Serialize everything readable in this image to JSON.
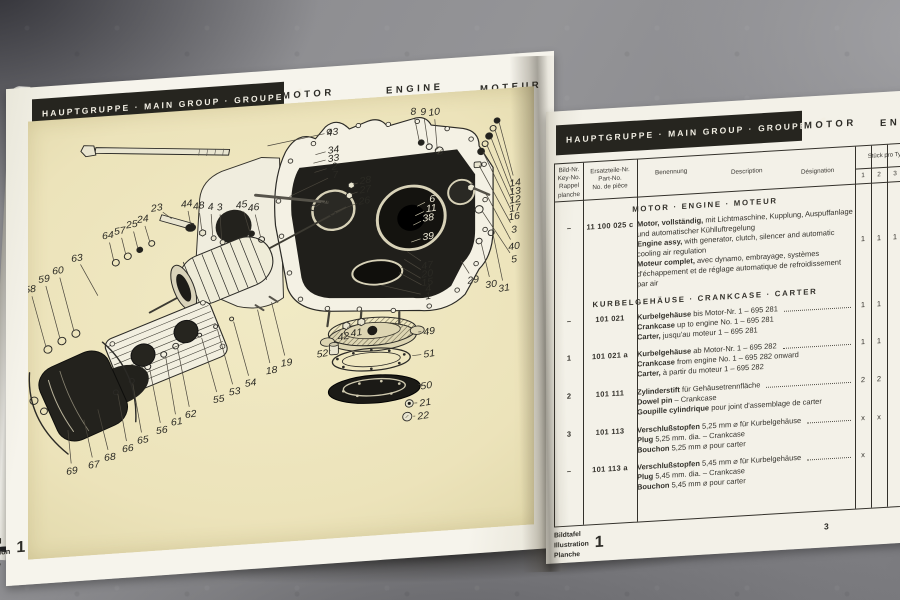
{
  "colors": {
    "plate_background": "#f1eac5",
    "header_bar": "#26251f",
    "page_paper": "#f3f1e8",
    "table_ink": "#33312b"
  },
  "left_page": {
    "header": {
      "group_label": "HAUPTGRUPPE · MAIN GROUP · GROUPE",
      "group_number": "1",
      "motor": "MOTOR",
      "engine": "ENGINE",
      "moteur": "MOTEUR"
    },
    "plate_caption": {
      "lines": [
        "Bildtafel",
        "Illustration",
        "Planche"
      ],
      "number": "1"
    },
    "callouts": [
      {
        "n": "43",
        "x": 305,
        "y": 34,
        "tx": 240,
        "ty": 44
      },
      {
        "n": "34",
        "x": 306,
        "y": 53,
        "tx": 288,
        "ty": 57
      },
      {
        "n": "33",
        "x": 306,
        "y": 62,
        "tx": 286,
        "ty": 66
      },
      {
        "n": "2",
        "x": 307,
        "y": 71,
        "tx": 287,
        "ty": 76
      },
      {
        "n": "7",
        "x": 308,
        "y": 80,
        "tx": 262,
        "ty": 100
      },
      {
        "n": "8",
        "x": 386,
        "y": 18,
        "tx": 392,
        "ty": 50
      },
      {
        "n": "9",
        "x": 396,
        "y": 19,
        "tx": 401,
        "ty": 55
      },
      {
        "n": "10",
        "x": 407,
        "y": 20,
        "tx": 410,
        "ty": 60
      },
      {
        "n": "23",
        "x": 129,
        "y": 102,
        "tx": 144,
        "ty": 115
      },
      {
        "n": "44",
        "x": 159,
        "y": 100,
        "tx": 163,
        "ty": 123
      },
      {
        "n": "48",
        "x": 171,
        "y": 103,
        "tx": 174,
        "ty": 129
      },
      {
        "n": "4",
        "x": 183,
        "y": 105,
        "tx": 185,
        "ty": 136
      },
      {
        "n": "3",
        "x": 192,
        "y": 106,
        "tx": 194,
        "ty": 141
      },
      {
        "n": "45",
        "x": 214,
        "y": 105,
        "tx": 222,
        "ty": 134
      },
      {
        "n": "46",
        "x": 226,
        "y": 109,
        "tx": 233,
        "ty": 141
      },
      {
        "n": "24",
        "x": 115,
        "y": 113,
        "tx": 122,
        "ty": 138
      },
      {
        "n": "25",
        "x": 104,
        "y": 118,
        "tx": 110,
        "ty": 144
      },
      {
        "n": "57",
        "x": 92,
        "y": 124,
        "tx": 98,
        "ty": 150
      },
      {
        "n": "64",
        "x": 80,
        "y": 128,
        "tx": 86,
        "ty": 156
      },
      {
        "n": "63",
        "x": 49,
        "y": 150,
        "tx": 70,
        "ty": 192
      },
      {
        "n": "60",
        "x": 30,
        "y": 162,
        "tx": 46,
        "ty": 228
      },
      {
        "n": "59",
        "x": 16,
        "y": 170,
        "tx": 32,
        "ty": 235
      },
      {
        "n": "58",
        "x": 2,
        "y": 180,
        "tx": 18,
        "ty": 243
      },
      {
        "n": "28",
        "x": 338,
        "y": 88,
        "tx": 326,
        "ty": 92
      },
      {
        "n": "27",
        "x": 338,
        "y": 98,
        "tx": 324,
        "ty": 102
      },
      {
        "n": "26",
        "x": 337,
        "y": 110,
        "tx": 307,
        "ty": 120
      },
      {
        "n": "32",
        "x": 299,
        "y": 106,
        "tx": 288,
        "ty": 113
      },
      {
        "n": "6",
        "x": 405,
        "y": 113,
        "tx": 390,
        "ty": 120,
        "light": true
      },
      {
        "n": "11",
        "x": 404,
        "y": 123,
        "tx": 388,
        "ty": 130,
        "light": true
      },
      {
        "n": "38",
        "x": 401,
        "y": 133,
        "tx": 386,
        "ty": 140,
        "light": true
      },
      {
        "n": "39",
        "x": 401,
        "y": 153,
        "tx": 384,
        "ty": 158,
        "light": true
      },
      {
        "n": "14",
        "x": 488,
        "y": 102,
        "tx": 472,
        "ty": 36
      },
      {
        "n": "13",
        "x": 488,
        "y": 111,
        "tx": 468,
        "ty": 44
      },
      {
        "n": "12",
        "x": 488,
        "y": 120,
        "tx": 464,
        "ty": 52
      },
      {
        "n": "17",
        "x": 488,
        "y": 129,
        "tx": 460,
        "ty": 60
      },
      {
        "n": "16",
        "x": 487,
        "y": 138,
        "tx": 456,
        "ty": 67
      },
      {
        "n": "3",
        "x": 487,
        "y": 152,
        "tx": 452,
        "ty": 81
      },
      {
        "n": "40",
        "x": 487,
        "y": 170,
        "tx": 458,
        "ty": 110
      },
      {
        "n": "5",
        "x": 487,
        "y": 184,
        "tx": 455,
        "ty": 130
      },
      {
        "n": "29",
        "x": 446,
        "y": 203,
        "tx": 434,
        "ty": 182
      },
      {
        "n": "30",
        "x": 464,
        "y": 209,
        "tx": 454,
        "ty": 164
      },
      {
        "n": "31",
        "x": 477,
        "y": 214,
        "tx": 466,
        "ty": 156
      },
      {
        "n": "47",
        "x": 400,
        "y": 184,
        "tx": 380,
        "ty": 168
      },
      {
        "n": "20",
        "x": 400,
        "y": 193,
        "tx": 377,
        "ty": 176
      },
      {
        "n": "15",
        "x": 400,
        "y": 202,
        "tx": 374,
        "ty": 184
      },
      {
        "n": "4",
        "x": 401,
        "y": 209,
        "tx": 372,
        "ty": 190
      },
      {
        "n": "1",
        "x": 401,
        "y": 217,
        "tx": 354,
        "ty": 202
      },
      {
        "n": "42",
        "x": 316,
        "y": 254,
        "tx": 321,
        "ty": 244
      },
      {
        "n": "41",
        "x": 329,
        "y": 251,
        "tx": 333,
        "ty": 242
      },
      {
        "n": "49",
        "x": 402,
        "y": 255,
        "tx": 391,
        "ty": 255
      },
      {
        "n": "51",
        "x": 402,
        "y": 279,
        "tx": 385,
        "ty": 280
      },
      {
        "n": "50",
        "x": 399,
        "y": 313,
        "tx": 395,
        "ty": 312
      },
      {
        "n": "21",
        "x": 398,
        "y": 331,
        "tx": 387,
        "ty": 331
      },
      {
        "n": "22",
        "x": 396,
        "y": 345,
        "tx": 386,
        "ty": 345
      },
      {
        "n": "52",
        "x": 295,
        "y": 271,
        "tx": 303,
        "ty": 268
      },
      {
        "n": "69",
        "x": 44,
        "y": 378,
        "tx": 40,
        "ty": 334
      },
      {
        "n": "67",
        "x": 66,
        "y": 373,
        "tx": 56,
        "ty": 324
      },
      {
        "n": "68",
        "x": 82,
        "y": 366,
        "tx": 70,
        "ty": 314
      },
      {
        "n": "66",
        "x": 100,
        "y": 358,
        "tx": 90,
        "ty": 299
      },
      {
        "n": "65",
        "x": 115,
        "y": 350,
        "tx": 105,
        "ty": 289
      },
      {
        "n": "56",
        "x": 134,
        "y": 341,
        "tx": 122,
        "ty": 275
      },
      {
        "n": "61",
        "x": 149,
        "y": 333,
        "tx": 138,
        "ty": 263
      },
      {
        "n": "62",
        "x": 163,
        "y": 326,
        "tx": 150,
        "ty": 255
      },
      {
        "n": "55",
        "x": 191,
        "y": 312,
        "tx": 174,
        "ty": 245
      },
      {
        "n": "53",
        "x": 207,
        "y": 305,
        "tx": 190,
        "ty": 238
      },
      {
        "n": "54",
        "x": 223,
        "y": 297,
        "tx": 206,
        "ty": 230
      },
      {
        "n": "18",
        "x": 244,
        "y": 285,
        "tx": 230,
        "ty": 219
      },
      {
        "n": "19",
        "x": 259,
        "y": 278,
        "tx": 244,
        "ty": 212
      }
    ]
  },
  "right_page": {
    "header": {
      "group_label": "HAUPTGRUPPE · MAIN GROUP · GROUPE",
      "group_number": "1",
      "motor": "MOTOR",
      "engine": "ENGINE"
    },
    "table": {
      "key_col_header": [
        "Bild-Nr.",
        "Key-No.",
        "Rappel",
        "planche"
      ],
      "part_col_header": [
        "Ersatzteile-Nr.",
        "Part-No.",
        "No. de pièce"
      ],
      "desc_col_header": [
        "Benennung",
        "Description",
        "Désignation"
      ],
      "qty_group_header": "Stück pro Typ",
      "qty_col_headers": [
        "1",
        "2",
        "3"
      ],
      "sections": [
        {
          "title": "MOTOR · ENGINE · MOTEUR",
          "rows": [
            {
              "key": "–",
              "part": "11 100 025 c",
              "dots": false,
              "qty": [
                "1",
                "1",
                "1"
              ],
              "lines": [
                [
                  "Motor, vollständig,",
                  "mit Lichtmaschine, Kupplung, Auspuffanlage und automatischer Kühlluftregelung"
                ],
                [
                  "Engine assy,",
                  "with generator, clutch, silencer and automatic cooling air regulation"
                ],
                [
                  "Moteur complet,",
                  "avec dynamo, embrayage, systèmes d'échappement et de réglage automatique de refroidissement par air"
                ]
              ]
            }
          ]
        },
        {
          "title": "KURBELGEHÄUSE · CRANKCASE · CARTER",
          "rows": [
            {
              "key": "–",
              "part": "101 021",
              "dots": true,
              "qty": [
                "1",
                "1",
                ""
              ],
              "lines": [
                [
                  "Kurbelgehäuse",
                  "bis Motor-Nr. 1 – 695 281"
                ],
                [
                  "Crankcase",
                  "up to engine No. 1 – 695 281"
                ],
                [
                  "Carter,",
                  "jusqu'au moteur 1 – 695 281"
                ]
              ]
            },
            {
              "key": "1",
              "part": "101 021 a",
              "dots": true,
              "qty": [
                "1",
                "1",
                ""
              ],
              "lines": [
                [
                  "Kurbelgehäuse",
                  "ab Motor-Nr. 1 – 695 282"
                ],
                [
                  "Crankcase",
                  "from engine No. 1 – 695 282 onward"
                ],
                [
                  "Carter,",
                  "à partir du moteur 1 – 695 282"
                ]
              ]
            },
            {
              "key": "2",
              "part": "101 111",
              "dots": true,
              "qty": [
                "2",
                "2",
                ""
              ],
              "lines": [
                [
                  "Zylinderstift",
                  "für Gehäusetrennfläche"
                ],
                [
                  "Dowel pin",
                  "– Crankcase"
                ],
                [
                  "Goupille cylindrique",
                  "pour joint d'assemblage de carter"
                ]
              ]
            },
            {
              "key": "3",
              "part": "101 113",
              "dots": true,
              "qty": [
                "x",
                "x",
                ""
              ],
              "lines": [
                [
                  "Verschlußstopfen",
                  "5,25 mm ⌀ für Kurbelgehäuse"
                ],
                [
                  "Plug",
                  "5,25 mm. dia. – Crankcase"
                ],
                [
                  "Bouchon",
                  "5,25 mm ⌀ pour carter"
                ]
              ]
            },
            {
              "key": "–",
              "part": "101 113 a",
              "dots": true,
              "qty": [
                "x",
                "",
                ""
              ],
              "lines": [
                [
                  "Verschlußstopfen",
                  "5,45 mm ⌀ für Kurbelgehäuse"
                ],
                [
                  "Plug",
                  "5,45 mm. dia. – Crankcase"
                ],
                [
                  "Bouchon",
                  "5,45 mm ⌀ pour carter"
                ]
              ]
            }
          ]
        }
      ]
    },
    "footer": {
      "caption_lines": [
        "Bildtafel",
        "Illustration",
        "Planche"
      ],
      "plate_number": "1",
      "page_number": "3"
    }
  }
}
